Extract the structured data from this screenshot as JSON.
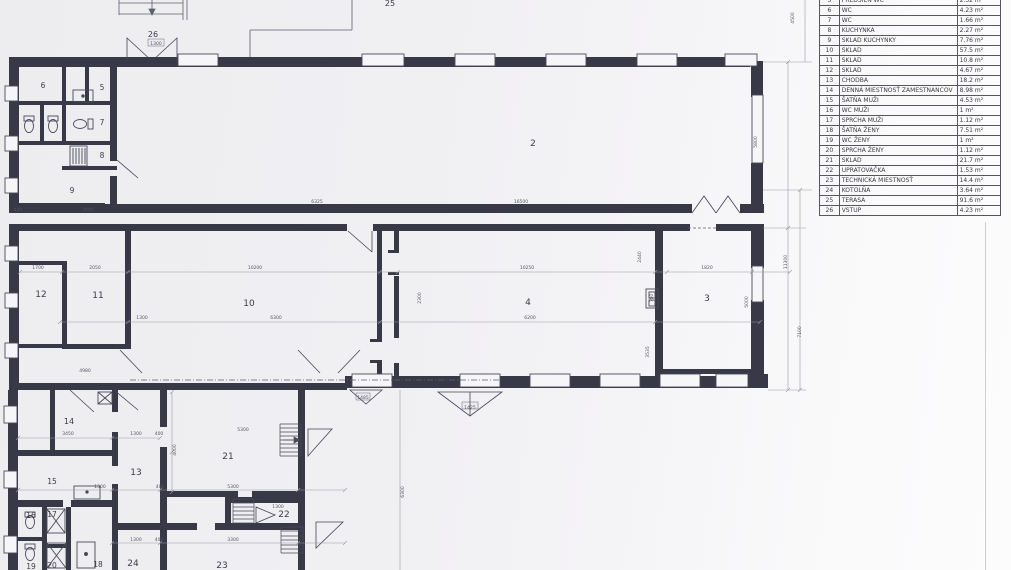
{
  "legend": {
    "rows": [
      {
        "num": "5",
        "name": "PREDSIEŇ WC",
        "area": "2.52 m²"
      },
      {
        "num": "6",
        "name": "WC",
        "area": "4.23 m²"
      },
      {
        "num": "7",
        "name": "WC",
        "area": "1.66 m²"
      },
      {
        "num": "8",
        "name": "KUCHYNKA",
        "area": "2.27 m²"
      },
      {
        "num": "9",
        "name": "SKLAD KUCHYNKY",
        "area": "7.76 m²"
      },
      {
        "num": "10",
        "name": "SKLAD",
        "area": "57.5 m²"
      },
      {
        "num": "11",
        "name": "SKLAD",
        "area": "10.8 m²"
      },
      {
        "num": "12",
        "name": "SKLAD",
        "area": "4.67 m²"
      },
      {
        "num": "13",
        "name": "CHODBA",
        "area": "18.2 m²"
      },
      {
        "num": "14",
        "name": "DENNÁ MIESTNOSŤ ZAMESTNANCOV",
        "area": "8.98 m²"
      },
      {
        "num": "15",
        "name": "ŠATŇA MUŽI",
        "area": "4.53 m²"
      },
      {
        "num": "16",
        "name": "WC MUŽI",
        "area": "1 m²"
      },
      {
        "num": "17",
        "name": "SPRCHA  MUŽI",
        "area": "1.12 m²"
      },
      {
        "num": "18",
        "name": "ŠATŇA ŽENY",
        "area": "7.51 m²"
      },
      {
        "num": "19",
        "name": "WC ŽENY",
        "area": "1 m²"
      },
      {
        "num": "20",
        "name": "SPRCHA ŽENY",
        "area": "1.12 m²"
      },
      {
        "num": "21",
        "name": "SKLAD",
        "area": "21.7 m²"
      },
      {
        "num": "22",
        "name": "UPRATOVAČKA",
        "area": "1.53 m²"
      },
      {
        "num": "23",
        "name": "TECHNICKÁ MIESTNOSŤ",
        "area": "14.4 m²"
      },
      {
        "num": "24",
        "name": "KOTOLŇA",
        "area": "3.64 m²"
      },
      {
        "num": "25",
        "name": "TERASA",
        "area": "91.6 m²"
      },
      {
        "num": "26",
        "name": "VSTUP",
        "area": "4.23 m²"
      }
    ]
  },
  "plan": {
    "room_labels": [
      {
        "id": "2",
        "x": 533,
        "y": 146,
        "fs": 9
      },
      {
        "id": "3",
        "x": 707,
        "y": 301,
        "fs": 9
      },
      {
        "id": "4",
        "x": 528,
        "y": 305,
        "fs": 9
      },
      {
        "id": "5",
        "x": 102,
        "y": 90,
        "fs": 7.5
      },
      {
        "id": "6",
        "x": 43,
        "y": 88,
        "fs": 7.5
      },
      {
        "id": "7",
        "x": 102,
        "y": 125,
        "fs": 7.5
      },
      {
        "id": "8",
        "x": 102,
        "y": 158,
        "fs": 7.5
      },
      {
        "id": "9",
        "x": 72,
        "y": 193,
        "fs": 7.5
      },
      {
        "id": "10",
        "x": 249,
        "y": 306,
        "fs": 9
      },
      {
        "id": "11",
        "x": 98,
        "y": 298,
        "fs": 9
      },
      {
        "id": "12",
        "x": 41,
        "y": 297,
        "fs": 9
      },
      {
        "id": "13",
        "x": 136,
        "y": 475,
        "fs": 9
      },
      {
        "id": "14",
        "x": 69,
        "y": 424,
        "fs": 8
      },
      {
        "id": "15",
        "x": 52,
        "y": 484,
        "fs": 7.5
      },
      {
        "id": "16",
        "x": 31,
        "y": 518,
        "fs": 7.5
      },
      {
        "id": "17",
        "x": 52,
        "y": 517,
        "fs": 7.5
      },
      {
        "id": "18",
        "x": 98,
        "y": 567,
        "fs": 7.5
      },
      {
        "id": "19",
        "x": 31,
        "y": 569,
        "fs": 7.5
      },
      {
        "id": "20",
        "x": 52,
        "y": 568,
        "fs": 7.5
      },
      {
        "id": "21",
        "x": 228,
        "y": 459,
        "fs": 9
      },
      {
        "id": "22",
        "x": 284,
        "y": 517,
        "fs": 9
      },
      {
        "id": "23",
        "x": 222,
        "y": 568,
        "fs": 9
      },
      {
        "id": "24",
        "x": 133,
        "y": 566,
        "fs": 9
      },
      {
        "id": "25",
        "x": 390,
        "y": 6,
        "fs": 8
      },
      {
        "id": "26",
        "x": 153,
        "y": 37,
        "fs": 8
      }
    ],
    "dim_labels": [
      {
        "text": "6325",
        "x": 317,
        "y": 203,
        "rot": 0
      },
      {
        "text": "16500",
        "x": 521,
        "y": 203,
        "rot": 0
      },
      {
        "text": "1700",
        "x": 38,
        "y": 269,
        "rot": 0
      },
      {
        "text": "2050",
        "x": 95,
        "y": 269,
        "rot": 0
      },
      {
        "text": "10200",
        "x": 255,
        "y": 269,
        "rot": 0
      },
      {
        "text": "10250",
        "x": 527,
        "y": 269,
        "rot": 0
      },
      {
        "text": "1820",
        "x": 707,
        "y": 269,
        "rot": 0
      },
      {
        "text": "1300",
        "x": 142,
        "y": 319,
        "rot": 0
      },
      {
        "text": "6300",
        "x": 276,
        "y": 319,
        "rot": 0
      },
      {
        "text": "6200",
        "x": 530,
        "y": 319,
        "rot": 0
      },
      {
        "text": "4980",
        "x": 85,
        "y": 372,
        "rot": 0
      },
      {
        "text": "3450",
        "x": 68,
        "y": 435,
        "rot": 0
      },
      {
        "text": "1300",
        "x": 136,
        "y": 435,
        "rot": 0
      },
      {
        "text": "400",
        "x": 159,
        "y": 435,
        "rot": 0
      },
      {
        "text": "1300",
        "x": 100,
        "y": 488,
        "rot": 0
      },
      {
        "text": "400",
        "x": 160,
        "y": 488,
        "rot": 0
      },
      {
        "text": "5300",
        "x": 233,
        "y": 488,
        "rot": 0
      },
      {
        "text": "1300",
        "x": 136,
        "y": 541,
        "rot": 0
      },
      {
        "text": "400",
        "x": 159,
        "y": 541,
        "rot": 0
      },
      {
        "text": "3300",
        "x": 233,
        "y": 541,
        "rot": 0
      },
      {
        "text": "5300",
        "x": 243,
        "y": 431,
        "rot": 0
      },
      {
        "text": "1300",
        "x": 278,
        "y": 508,
        "rot": 0
      },
      {
        "text": "1425",
        "x": 470,
        "y": 409,
        "rot": 0
      },
      {
        "text": "1485",
        "x": 363,
        "y": 399,
        "rot": 0
      },
      {
        "text": "1300",
        "x": 156,
        "y": 45,
        "rot": 0
      },
      {
        "text": "3600",
        "x": 88,
        "y": 211,
        "rot": 0
      },
      {
        "text": "400",
        "x": 18,
        "y": 211,
        "rot": 0
      },
      {
        "text": "6300",
        "x": 404,
        "y": 492,
        "rot": -90
      },
      {
        "text": "11300",
        "x": 787,
        "y": 262,
        "rot": -90
      },
      {
        "text": "7100",
        "x": 801,
        "y": 332,
        "rot": -90
      },
      {
        "text": "4500",
        "x": 794,
        "y": 18,
        "rot": -90
      },
      {
        "text": "5800",
        "x": 757,
        "y": 142,
        "rot": -90
      },
      {
        "text": "5000",
        "x": 748,
        "y": 302,
        "rot": -90
      },
      {
        "text": "2440",
        "x": 641,
        "y": 257,
        "rot": -90
      },
      {
        "text": "3535",
        "x": 649,
        "y": 352,
        "rot": -90
      },
      {
        "text": "2300",
        "x": 421,
        "y": 298,
        "rot": -90
      },
      {
        "text": "750",
        "x": 653,
        "y": 298,
        "rot": -90
      },
      {
        "text": "4000",
        "x": 176,
        "y": 450,
        "rot": -90
      }
    ]
  }
}
